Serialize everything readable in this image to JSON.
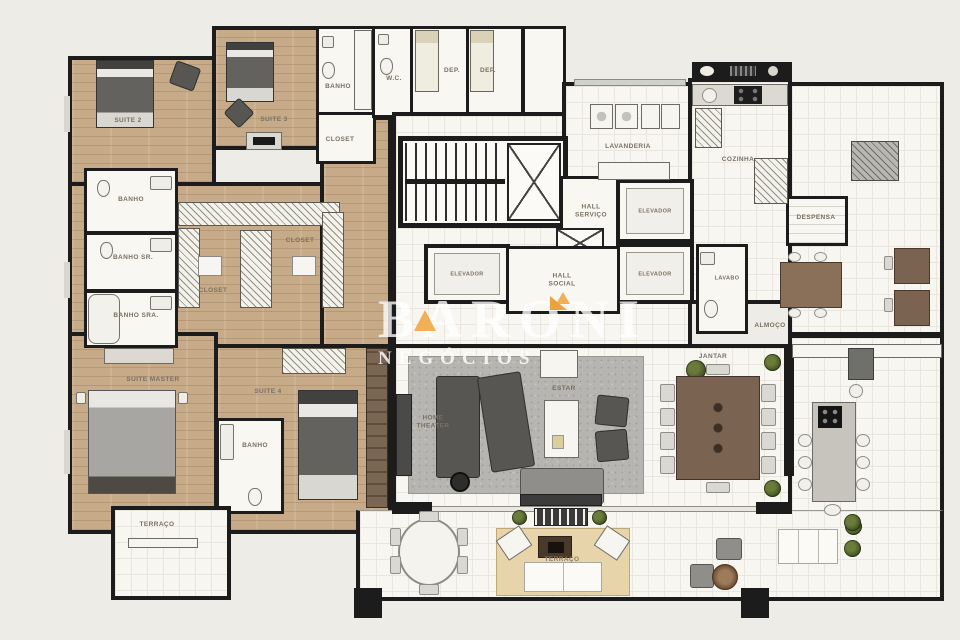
{
  "watermark": {
    "brand": "BARONI",
    "subtitle": "NEGÓCIOS",
    "accent_color": "#F0A33C"
  },
  "rooms": {
    "suite2": "SUITE 2",
    "suite3": "SUITE 3",
    "suite4": "SUITE 4",
    "suite_master": "SUITE MASTER",
    "banho_suite3": "BANHO",
    "closet_suite3": "CLOSET",
    "wc": "W.C.",
    "dep1": "DEP.",
    "dep2": "DEP.",
    "banho": "BANHO",
    "banho_sr": "BANHO SR.",
    "banho_sra": "BANHO SRA.",
    "closet1": "CLOSET",
    "closet2": "CLOSET",
    "banho_suite4": "BANHO",
    "terraco_master": "TERRAÇO",
    "hall_servico": "HALL SERVIÇO",
    "hall_social": "HALL SOCIAL",
    "elevador1": "ELEVADOR",
    "elevador2": "ELEVADOR",
    "elevador3": "ELEVADOR",
    "lavanderia": "LAVANDERIA",
    "cozinha": "COZINHA",
    "despensa": "DESPENSA",
    "lavabo": "LAVABO",
    "almoco": "ALMOÇO",
    "jantar": "JANTAR",
    "estar": "ESTAR",
    "home_theater": "HOME THEATER",
    "terraco": "TERRAÇO"
  }
}
